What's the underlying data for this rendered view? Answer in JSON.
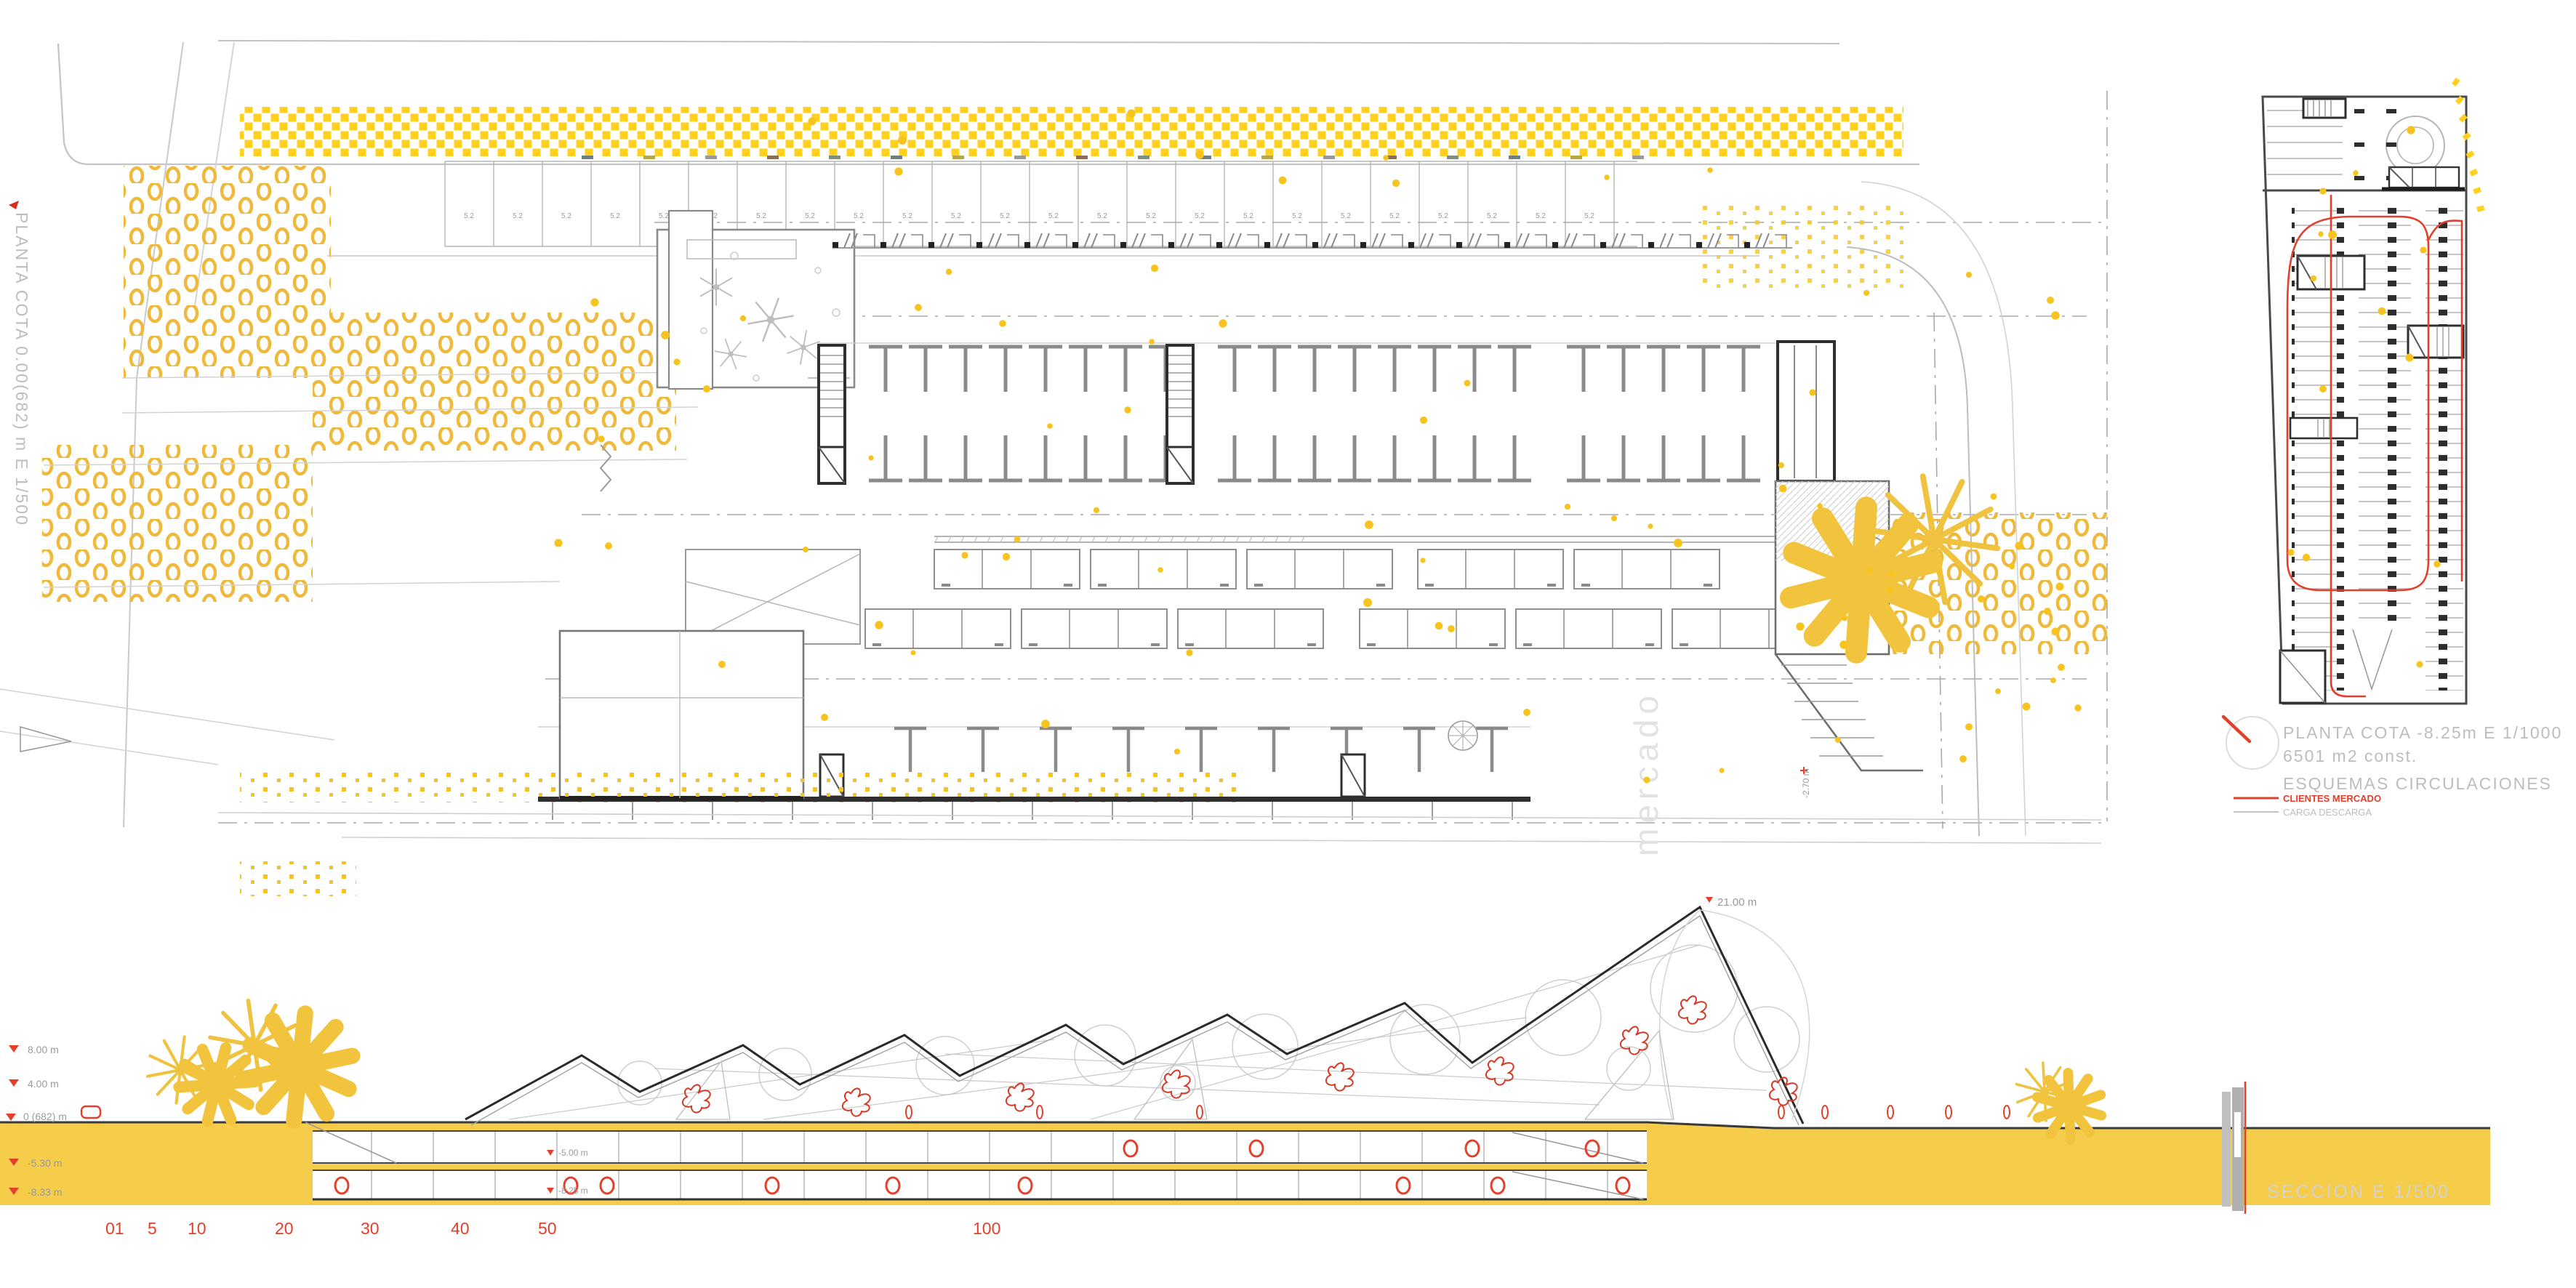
{
  "plan": {
    "title_vertical": "PLANTA COTA 0.00(682) m   E 1/500",
    "parking_dim": "5.2",
    "watermark": "mercado",
    "level_note": "-2.70 m"
  },
  "parking_diagram": {
    "caption_line1": "PLANTA COTA -8.25m   E 1/1000",
    "caption_line2": "6501 m2 const.",
    "legend_title": "ESQUEMAS CIRCULACIONES",
    "legend": [
      {
        "label": "CLIENTES MERCADO",
        "color": "#E2402C"
      },
      {
        "label": "CARGA DESCARGA",
        "color": "#b5b5b5"
      }
    ]
  },
  "section": {
    "title": "SECCION    E 1/500",
    "peak_label": "21.00 m",
    "levels": [
      "8.00 m",
      "4.00 m",
      "0 (682) m",
      "-5.30 m",
      "-8.33 m"
    ],
    "interior_labels": [
      "-5.00 m",
      "-8.25 m"
    ],
    "scale_numbers": [
      "01",
      "5",
      "10",
      "20",
      "30",
      "40",
      "50",
      "100"
    ]
  },
  "colors": {
    "ground_yellow": "#F5CD4B",
    "tree_yellow": "#FFD01C",
    "ring_yellow": "#EFBA3B",
    "dot_yellow": "#F7C41F",
    "accent_red": "#E2402C",
    "line_gray": "#9A9A9A",
    "text_gray": "#C2C2C2"
  }
}
